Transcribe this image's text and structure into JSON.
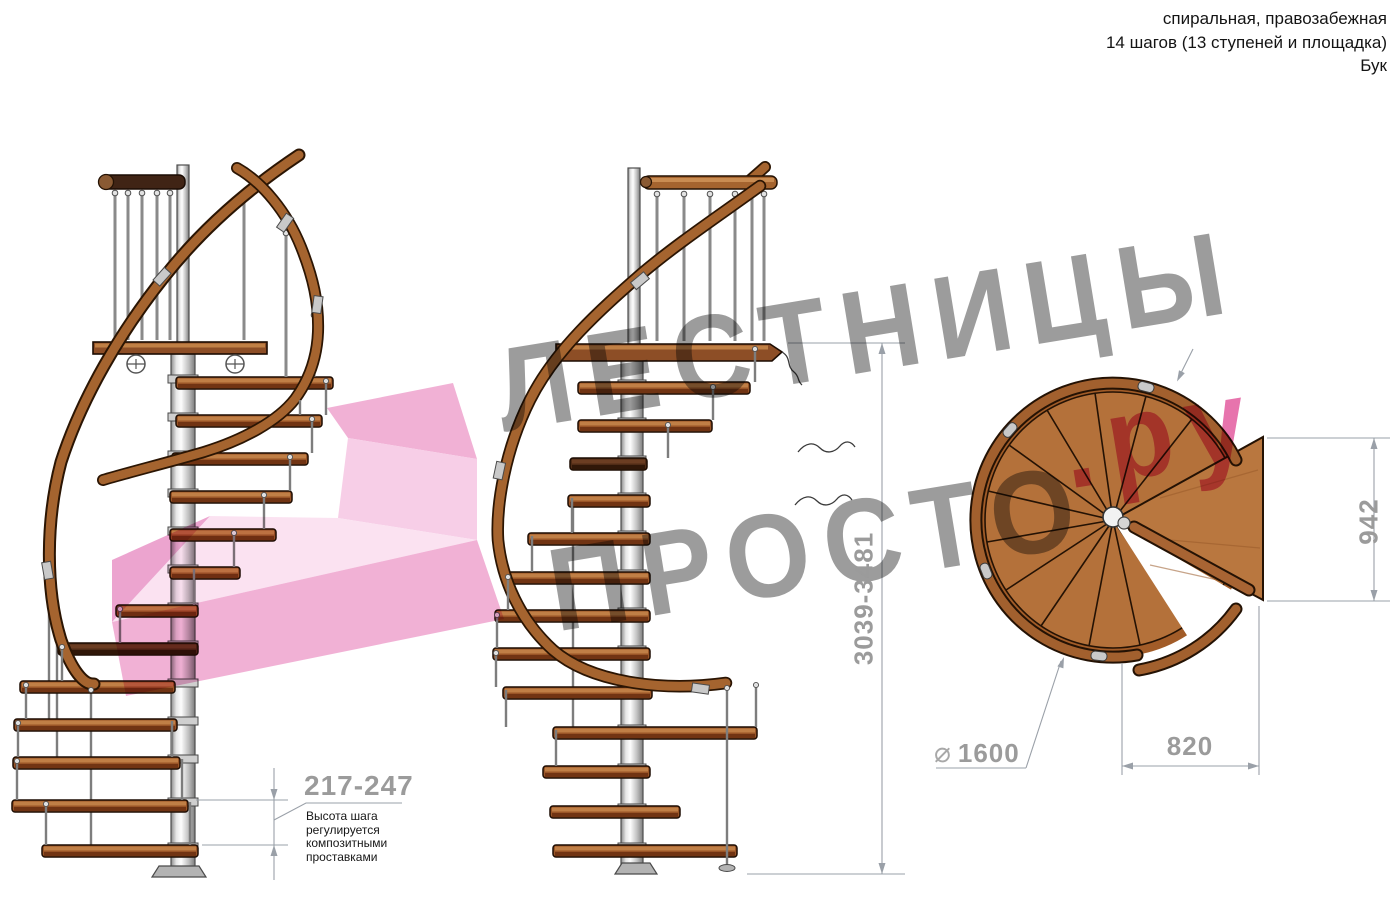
{
  "header": {
    "line1": "спиральная, правозабежная",
    "line2": "14 шагов (13 ступеней и площадка)",
    "line3": "Бук"
  },
  "watermark": {
    "word1": "ЛЕСТНИЦЫ",
    "word2": "ПРОСТО",
    "suffix": ".ру",
    "gray": "#9e9e9e",
    "pink": "#e2569b"
  },
  "dimensions": {
    "total_height": "3039-3481",
    "step_height": "217-247",
    "note_line1": "Высота шага",
    "note_line2": "регулируется",
    "note_line3": "композитными",
    "note_line4": "проставками",
    "landing_width": "942",
    "landing_depth": "820",
    "diameter_symbol": "⌀",
    "diameter_value": "1600"
  },
  "colors": {
    "wood": "#a5642f",
    "wood_dark": "#713413",
    "handrail_dark": "#402415",
    "steel": "#cfcfcf",
    "dim_gray": "#9b9b9b"
  }
}
